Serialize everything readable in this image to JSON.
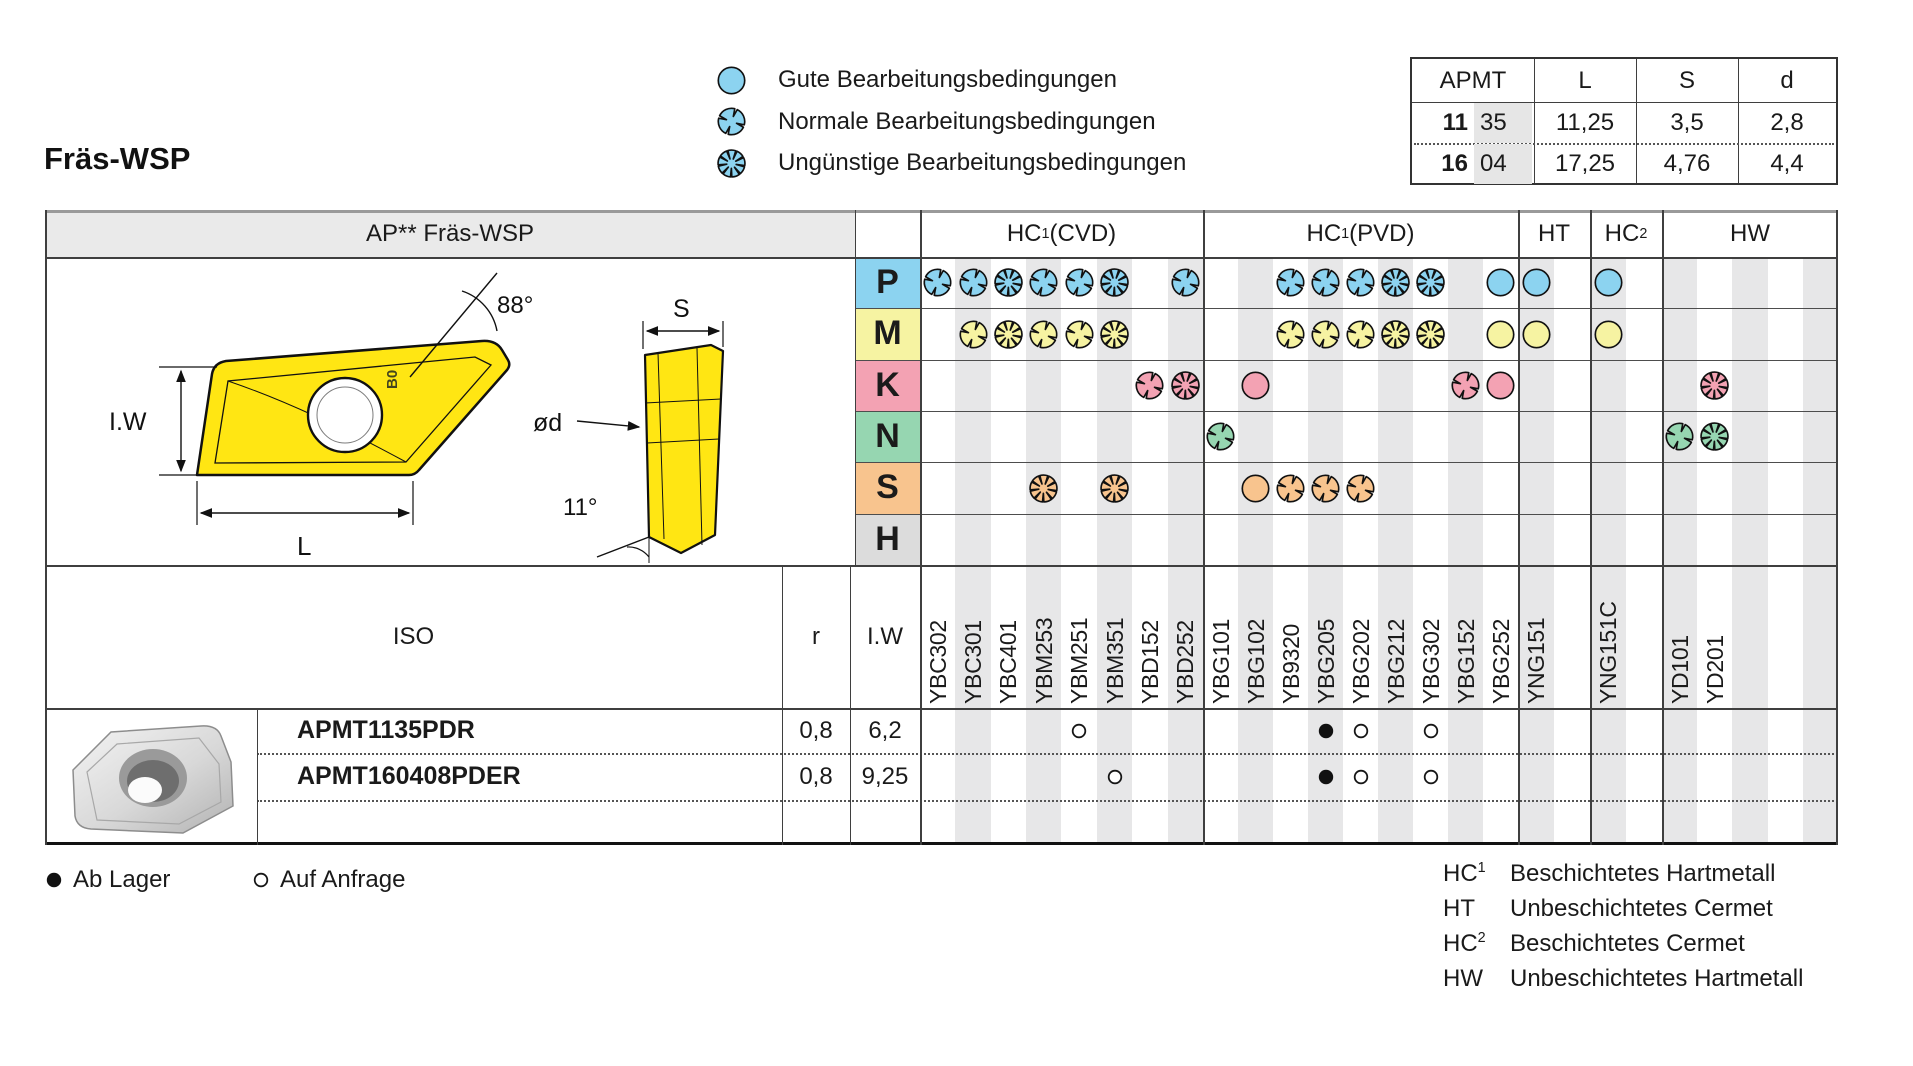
{
  "title": "Fräs-WSP",
  "accent_colors": {
    "p_blue": "#8cd3f0",
    "m_yellow": "#f6f3a2",
    "k_pink": "#f3a2b3",
    "n_green": "#96d6b1",
    "s_orange": "#f8c48e",
    "h_gray": "#dcdcdc",
    "stripe_gray": "#e7e7e8",
    "header_gray": "#eaeaea",
    "insert_yellow": "#ffe613"
  },
  "condition_legend": [
    {
      "icon": "good-condition-icon",
      "type": "good",
      "label": "Gute Bearbeitungsbedingungen"
    },
    {
      "icon": "normal-condition-icon",
      "type": "normal",
      "label": "Normale Bearbeitungsbedingungen"
    },
    {
      "icon": "unfavorable-condition-icon",
      "type": "unfavorable",
      "label": "Ungünstige Bearbeitungsbedingungen"
    }
  ],
  "dimension_table": {
    "headers": [
      "APMT",
      "L",
      "S",
      "d"
    ],
    "rows": [
      {
        "size_bold": "11",
        "size_rest": "35",
        "L": "11,25",
        "S": "3,5",
        "d": "2,8"
      },
      {
        "size_bold": "16",
        "size_rest": "04",
        "L": "17,25",
        "S": "4,76",
        "d": "4,4"
      }
    ]
  },
  "matrix": {
    "left_header": "AP** Fräs-WSP",
    "grade_groups": [
      {
        "name": "HC",
        "sup": "1",
        "qualifier": "(CVD)",
        "grades": [
          "YBC302",
          "YBC301",
          "YBC401",
          "YBM253",
          "YBM251",
          "YBM351",
          "YBD152",
          "YBD252"
        ]
      },
      {
        "name": "HC",
        "sup": "1",
        "qualifier": "(PVD)",
        "grades": [
          "YBG101",
          "YBG102",
          "YB9320",
          "YBG205",
          "YBG202",
          "YBG212",
          "YBG302",
          "YBG152",
          "YBG252"
        ]
      },
      {
        "name": "HT",
        "sup": "",
        "qualifier": "",
        "grades": [
          "YNG151"
        ]
      },
      {
        "name": "HC",
        "sup": "2",
        "qualifier": "",
        "grades": [
          "YNG151C"
        ]
      },
      {
        "name": "HW",
        "sup": "",
        "qualifier": "",
        "grades": [
          "YD101",
          "YD201"
        ]
      }
    ],
    "app_rows": [
      {
        "letter": "P",
        "color": "#8cd3f0",
        "marks": {
          "YBC302": "normal",
          "YBC301": "normal",
          "YBC401": "unfavorable",
          "YBM253": "normal",
          "YBM251": "normal",
          "YBM351": "unfavorable",
          "YBD252": "normal",
          "YB9320": "normal",
          "YBG205": "normal",
          "YBG202": "normal",
          "YBG212": "unfavorable",
          "YBG302": "unfavorable",
          "YBG252": "good",
          "YNG151": "good",
          "YNG151C": "good"
        }
      },
      {
        "letter": "M",
        "color": "#f6f3a2",
        "marks": {
          "YBC301": "normal",
          "YBC401": "unfavorable",
          "YBM253": "normal",
          "YBM251": "normal",
          "YBM351": "unfavorable",
          "YB9320": "normal",
          "YBG205": "normal",
          "YBG202": "normal",
          "YBG212": "unfavorable",
          "YBG302": "unfavorable",
          "YBG252": "good",
          "YNG151": "good",
          "YNG151C": "good"
        }
      },
      {
        "letter": "K",
        "color": "#f3a2b3",
        "marks": {
          "YBD152": "normal",
          "YBD252": "unfavorable",
          "YBG102": "good",
          "YBG152": "normal",
          "YBG252": "good",
          "YD201": "unfavorable"
        }
      },
      {
        "letter": "N",
        "color": "#96d6b1",
        "marks": {
          "YBG101": "normal",
          "YD101": "normal",
          "YD201": "unfavorable"
        }
      },
      {
        "letter": "S",
        "color": "#f8c48e",
        "marks": {
          "YBM253": "unfavorable",
          "YBM351": "unfavorable",
          "YBG102": "good",
          "YB9320": "normal",
          "YBG205": "normal",
          "YBG202": "normal"
        }
      },
      {
        "letter": "H",
        "color": "#dcdcdc",
        "marks": {}
      }
    ],
    "iso_header": {
      "iso": "ISO",
      "r": "r",
      "iw": "I.W"
    },
    "products": [
      {
        "designation": "APMT1135PDR",
        "r": "0,8",
        "iw": "6,2",
        "availability": {
          "YBM251": "request",
          "YBG205": "stock",
          "YBG202": "request",
          "YBG302": "request"
        }
      },
      {
        "designation": "APMT160408PDER",
        "r": "0,8",
        "iw": "9,25",
        "availability": {
          "YBM351": "request",
          "YBG205": "stock",
          "YBG202": "request",
          "YBG302": "request"
        }
      }
    ]
  },
  "drawing_labels": {
    "angle_top": "88°",
    "thickness": "S",
    "inscribed_width": "I.W",
    "length": "L",
    "hole_diameter": "ød",
    "clearance_angle": "11°",
    "face_mark": "B0"
  },
  "stock_legend": [
    {
      "mark": "stock",
      "label": "Ab Lager"
    },
    {
      "mark": "request",
      "label": "Auf Anfrage"
    }
  ],
  "material_legend": [
    {
      "code": "HC",
      "sup": "1",
      "label": "Beschichtetes Hartmetall"
    },
    {
      "code": "HT",
      "sup": "",
      "label": "Unbeschichtetes Cermet"
    },
    {
      "code": "HC",
      "sup": "2",
      "label": "Beschichtetes Cermet"
    },
    {
      "code": "HW",
      "sup": "",
      "label": "Unbeschichtetes Hartmetall"
    }
  ]
}
